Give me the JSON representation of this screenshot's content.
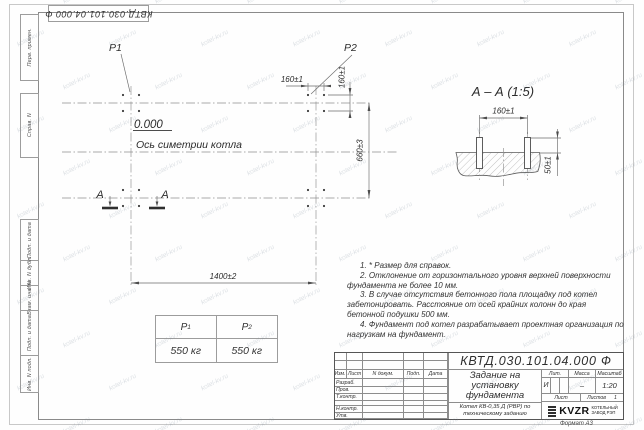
{
  "watermark": {
    "text": "kotel-kv.ru"
  },
  "doc_number": "КВТД.030.101.04.000  Ф",
  "sidebar": {
    "items": [
      "Перв. примен.",
      "Справ. N",
      "Подп. и дата",
      "Инв. N дубл.",
      "Взам. инв. N",
      "Подп. и дата",
      "Инв. N подл."
    ]
  },
  "plan": {
    "p1_label": "P1",
    "p2_label": "P2",
    "level_mark": "0.000",
    "symmetry_label": "Ось симетрии котла",
    "dim_span": "1400±2",
    "dim_depth": "660±3",
    "dim_bolt_horizontal": "160±1",
    "dim_bolt_vertical": "160±1",
    "section_mark": "А"
  },
  "section": {
    "title": "А – А (1:5)",
    "dim_bolt_spacing": "160±1",
    "dim_bolt_protrusion": "50±1"
  },
  "load_table": {
    "col1": {
      "base": "Р",
      "sub": "1"
    },
    "col2": {
      "base": "Р",
      "sub": "2"
    },
    "values": [
      "550 кг",
      "550 кг"
    ]
  },
  "notes": {
    "lines": [
      "1. * Размер для справок.",
      "2. Отклонение от горизонтального уровня верхней поверхности фундамента не более 10 мм.",
      "3. В случае отсутствия бетонного пола площадку под котел забетонировать. Расстояние от осей крайних колонн до края бетонной подушки 500 мм.",
      "4. Фундамент под котел разрабатывает проектная организация по нагрузкам на фундамент."
    ]
  },
  "titleblock": {
    "header_cols": [
      "Изм.",
      "Лист",
      "N докум.",
      "Подп.",
      "Дата"
    ],
    "row_labels": [
      "Разраб.",
      "Пров.",
      "Т.контр.",
      "",
      "Н.контр.",
      "Утв."
    ],
    "title": "Задание на установку фундамента",
    "subtitle": "Котел КВ-0,35 Д (РВР) по техническому заданию",
    "lit_header": "Лит.",
    "mass_header": "Масса",
    "scale_header": "Масштаб",
    "lit_value": "И",
    "mass_value": "–",
    "scale_value": "1:20",
    "sheet_label": "Лист",
    "sheets_label": "Листов",
    "sheets_value": "1",
    "logo_text": "KVZR",
    "logo_caption_line1": "КОТЕЛЬНЫЙ",
    "logo_caption_line2": "ЗАВОД РЭП",
    "format_label": "Формат А3"
  }
}
